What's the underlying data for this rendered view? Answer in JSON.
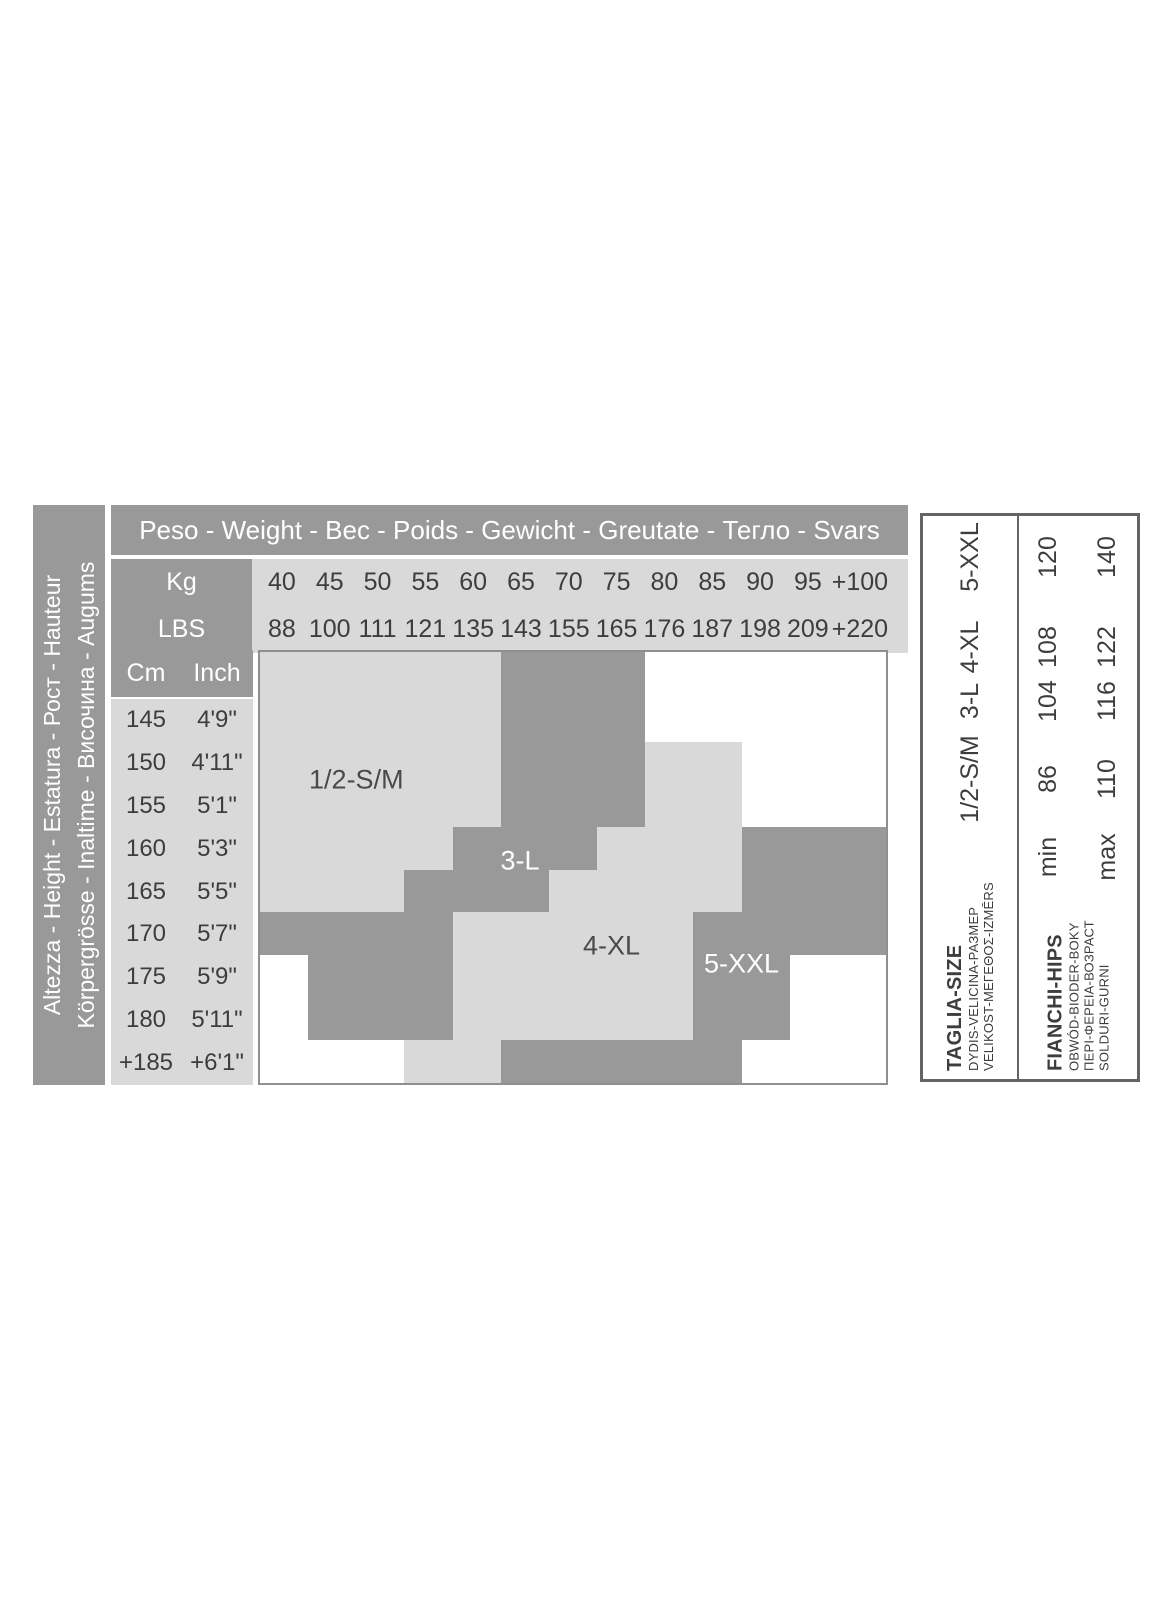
{
  "colors": {
    "mid_gray": "#999999",
    "light_gray": "#d9d9d9",
    "text_dark": "#3d3d3d",
    "chart_border": "#8f8f8f",
    "panel_border": "#646464"
  },
  "height_axis_bar": {
    "line1": "Altezza - Height - Estatura - Рост - Hauteur",
    "line2": "Körpergrösse - Inaltime - Височина - Augums"
  },
  "weight_table": {
    "title": "Peso - Weight - Вес - Poids - Gewicht - Greutate - Тегло - Svars",
    "kg_label": "Kg",
    "lbs_label": "LBS"
  },
  "height_table": {
    "cm_label": "Cm",
    "inch_label": "Inch"
  },
  "chart_data": {
    "type": "heatmap",
    "title": "Peso - Weight - Вес - Poids - Gewicht - Greutate - Тегло - Svars",
    "x_axis": {
      "kg": [
        "40",
        "45",
        "50",
        "55",
        "60",
        "65",
        "70",
        "75",
        "80",
        "85",
        "90",
        "95",
        "+100"
      ],
      "lbs": [
        "88",
        "100",
        "111",
        "121",
        "135",
        "143",
        "155",
        "165",
        "176",
        "187",
        "198",
        "209",
        "+220"
      ]
    },
    "y_axis": {
      "cm": [
        "145",
        "150",
        "155",
        "160",
        "165",
        "170",
        "175",
        "180",
        "+185"
      ],
      "inch": [
        "4'9\"",
        "4'11\"",
        "5'1\"",
        "5'3\"",
        "5'5\"",
        "5'7\"",
        "5'9\"",
        "5'11\"",
        "+6'1\""
      ]
    },
    "zones": [
      {
        "id": "sm",
        "label": "1/2-S/M",
        "shade": "light",
        "label_color": "dark",
        "label_col": 2.0,
        "label_row": 1.9,
        "rects": [
          [
            0,
            5,
            0,
            3
          ],
          [
            0,
            4,
            3,
            4
          ],
          [
            0,
            3,
            4,
            5
          ]
        ]
      },
      {
        "id": "l",
        "label": "3-L",
        "shade": "dark",
        "label_color": "white",
        "label_col": 5.4,
        "label_row": 3.8,
        "rects": [
          [
            5,
            8,
            0,
            3
          ],
          [
            4,
            7,
            3,
            4
          ],
          [
            3,
            6,
            4,
            5
          ],
          [
            0,
            4,
            5,
            6
          ],
          [
            1,
            4,
            6,
            8
          ]
        ]
      },
      {
        "id": "xl",
        "label": "4-XL",
        "shade": "light",
        "label_color": "dark",
        "label_col": 7.3,
        "label_row": 5.8,
        "rects": [
          [
            8,
            10,
            1,
            3
          ],
          [
            7,
            10,
            3,
            4
          ],
          [
            6,
            10,
            4,
            5
          ],
          [
            4,
            9,
            5,
            8
          ],
          [
            3,
            5,
            8,
            9
          ]
        ]
      },
      {
        "id": "xxl",
        "label": "5-XXL",
        "shade": "dark",
        "label_color": "white",
        "label_col": 10.0,
        "label_row": 6.2,
        "rects": [
          [
            10,
            13,
            3,
            5
          ],
          [
            9,
            13,
            5,
            6
          ],
          [
            9,
            11,
            6,
            8
          ],
          [
            5,
            10,
            8,
            9
          ]
        ]
      }
    ]
  },
  "size_hips_panel": {
    "size_header": {
      "title": "TAGLIA-SIZE",
      "sub1": "DYDIS-VELICINA-РАЗМЕР",
      "sub2": "VELIKOST-ΜΕΓΕΘΟΣ-IZMĒRS"
    },
    "sizes": [
      "1/2-S/M",
      "3-L",
      "4-XL",
      "5-XXL"
    ],
    "hips_header": {
      "title": "FIANCHI-HIPS",
      "sub1": "OBWÓD-BIODER-BOKY",
      "sub2": "ΠΕΡΙ-ΦΕΡΕΙΑ-ВОЗРАСТ",
      "sub3": "SOLDURI-GURNI"
    },
    "min_label": "min",
    "max_label": "max",
    "min_values": [
      "86",
      "104",
      "108",
      "120"
    ],
    "max_values": [
      "110",
      "116",
      "122",
      "140"
    ]
  }
}
